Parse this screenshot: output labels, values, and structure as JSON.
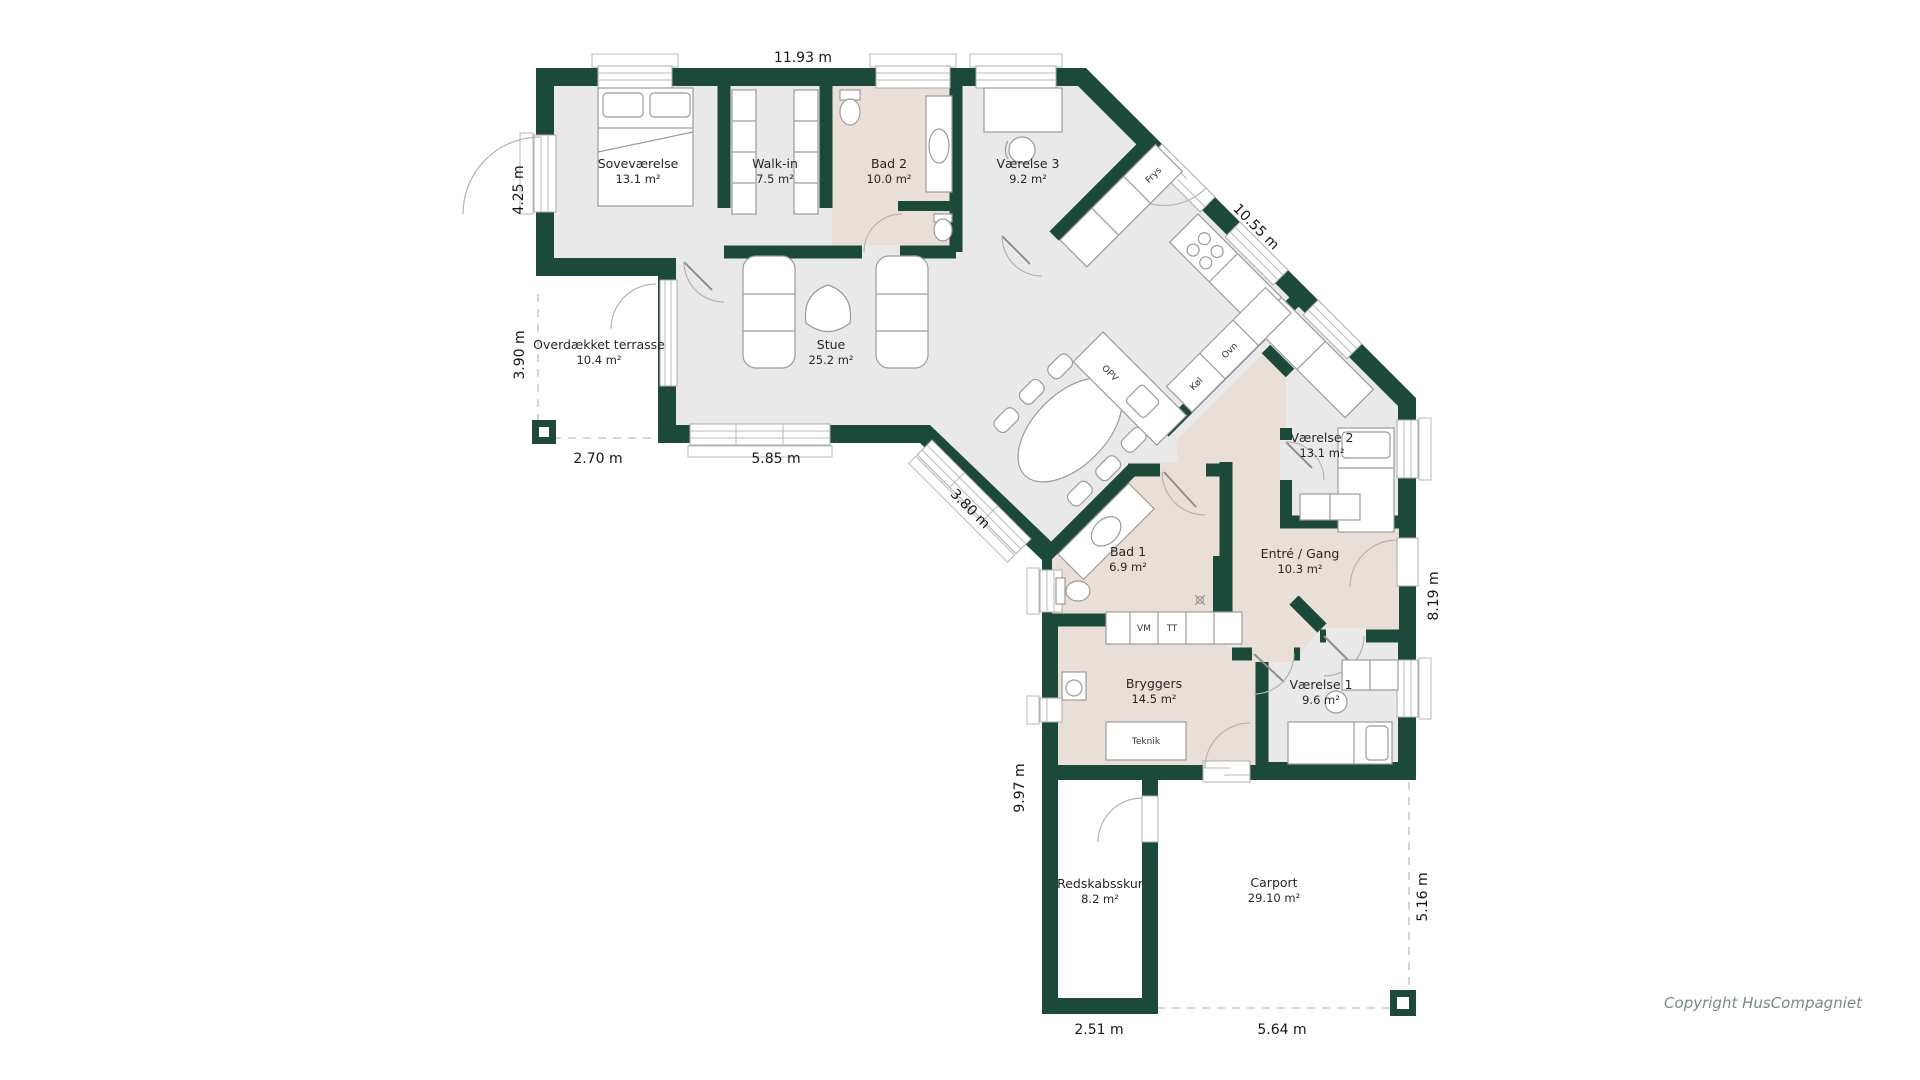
{
  "plan": {
    "rooms": [
      {
        "name": "Soveværelse",
        "area": "13.1 m²"
      },
      {
        "name": "Walk-in",
        "area": "7.5 m²"
      },
      {
        "name": "Bad 2",
        "area": "10.0 m²"
      },
      {
        "name": "Værelse 3",
        "area": "9.2 m²"
      },
      {
        "name": "Overdækket terrasse",
        "area": "10.4 m²"
      },
      {
        "name": "Stue",
        "area": "25.2 m²"
      },
      {
        "name": "Værelse 2",
        "area": "13.1 m²"
      },
      {
        "name": "Bad 1",
        "area": "6.9 m²"
      },
      {
        "name": "Entré / Gang",
        "area": "10.3 m²"
      },
      {
        "name": "Bryggers",
        "area": "14.5 m²"
      },
      {
        "name": "Værelse 1",
        "area": "9.6 m²"
      },
      {
        "name": "Redskabsskur",
        "area": "8.2 m²"
      },
      {
        "name": "Carport",
        "area": "29.10 m²"
      }
    ],
    "dimensions": [
      {
        "label": "11.93 m"
      },
      {
        "label": "4.25 m"
      },
      {
        "label": "3.90 m"
      },
      {
        "label": "2.70 m"
      },
      {
        "label": "5.85 m"
      },
      {
        "label": "3.80 m"
      },
      {
        "label": "10.55 m"
      },
      {
        "label": "8.19 m"
      },
      {
        "label": "9.97 m"
      },
      {
        "label": "5.16 m"
      },
      {
        "label": "2.51 m"
      },
      {
        "label": "5.64 m"
      }
    ],
    "appliances": {
      "frys": "Frys",
      "kol": "Køl",
      "ovn": "Ovn",
      "opv": "OPV",
      "vm": "VM",
      "tt": "TT",
      "teknik": "Teknik"
    },
    "copyright": "Copyright HusCompagniet",
    "colors": {
      "wall": "#1c4a3a",
      "floor": "#e9e9e9",
      "wet_room": "#eadfd7"
    }
  }
}
